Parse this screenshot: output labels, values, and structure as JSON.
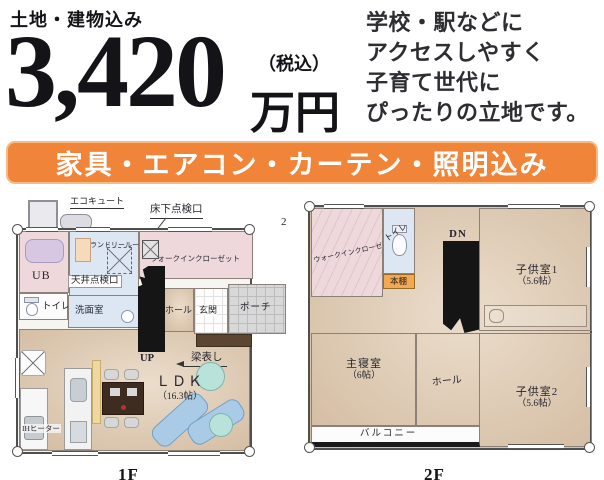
{
  "header": {
    "included_label": "土地・建物込み",
    "price_value": "3,420",
    "price_unit": "万円",
    "tax_note": "（税込）",
    "catch_lines": {
      "line1": "学校・駅などに",
      "line2": "アクセスしやすく",
      "line3": "子育て世代に",
      "line4": "ぴったりの立地です。"
    }
  },
  "banner": {
    "text": "家具・エアコン・カーテン・照明込み",
    "bg_color": "#F08439",
    "text_color": "#FFFFFF"
  },
  "colors": {
    "room_pink": "#EFD8DC",
    "room_blue": "#DCE7F3",
    "floor_tan": "#D8C2A9",
    "sofa_blue": "#A9CBE6",
    "table_teal": "#B9E2DB",
    "bookshelf_orange": "#F3A852"
  },
  "floor1": {
    "floor_label": "1F",
    "ecocute": "エコキュート",
    "underfloor_hatch": "床下点検口",
    "unit_bath": "UB",
    "laundry": "ランドリールーム",
    "ceiling_hatch": "天井点検口",
    "walk_in_closet": "ウォークインクローゼット",
    "toilet": "トイレ",
    "washroom": "洗面室",
    "hall": "ホール",
    "entrance": "玄関",
    "porch": "ポーチ",
    "stairs_up": "UP",
    "exposed_beam": "梁表し",
    "ldk": "ＬＤＫ",
    "ldk_area": "（16.3帖）",
    "ih_heater": "IHヒーター"
  },
  "floor2": {
    "floor_label": "2F",
    "grid_mark": "2",
    "walk_in_closet": "ウォークインクローゼット",
    "toilet": "トイレ",
    "stairs_down": "DN",
    "bookshelf": "本棚",
    "kids_room1": "子供室1",
    "kids_room1_area": "（5.6帖）",
    "master_bedroom": "主寝室",
    "master_bedroom_area": "（6帖）",
    "hall": "ホール",
    "kids_room2": "子供室2",
    "kids_room2_area": "（5.6帖）",
    "balcony": "バルコニー"
  }
}
